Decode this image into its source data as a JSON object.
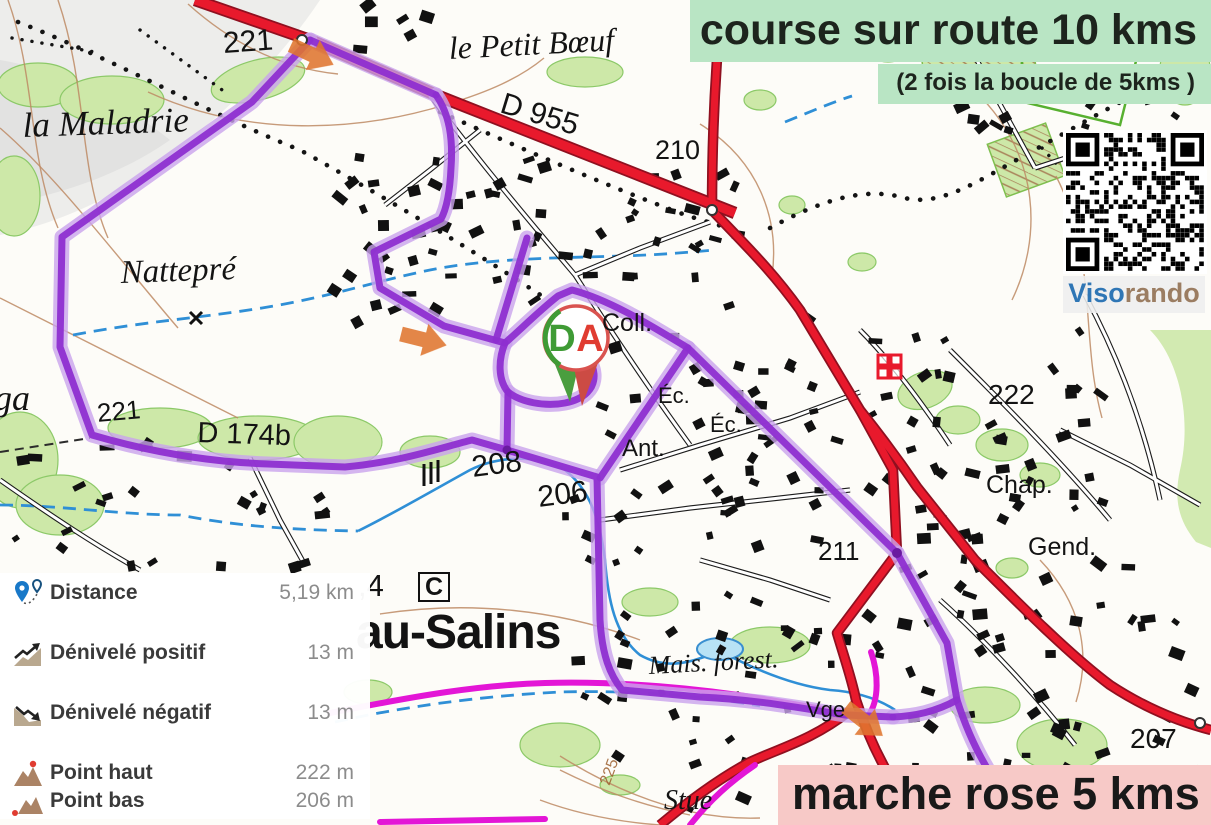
{
  "colors": {
    "route_purple": "#8e2fd0",
    "route_magenta": "#e316d6",
    "road_red": "#e8192c",
    "banner_green": "#b9e5c4",
    "banner_pink": "#f7c9c7",
    "brand_blue_color": "#2f76b5",
    "brand_brown_color": "#9b7d62"
  },
  "banners": {
    "top_text": "course sur route 10 kms",
    "top_subtitle": "(2 fois la boucle de 5kms )",
    "bottom_text": "marche rose 5 kms"
  },
  "brand": {
    "blue_part": "Viso",
    "brown_part": "rando"
  },
  "marker": {
    "depart_label": "D",
    "arrivee_label": "A"
  },
  "stats_panel": {
    "rows": [
      {
        "icon": "distance-icon",
        "label": "Distance",
        "value": "5,19 km"
      },
      {
        "icon": "ascent-icon",
        "label": "Dénivelé positif",
        "value": "13 m"
      },
      {
        "icon": "descent-icon",
        "label": "Dénivelé négatif",
        "value": "13 m"
      },
      {
        "icon": "high-point-icon",
        "label": "Point haut",
        "value": "222 m"
      },
      {
        "icon": "low-point-icon",
        "label": "Point bas",
        "value": "206 m"
      }
    ]
  },
  "map_labels": [
    {
      "text": "221",
      "x": 222,
      "y": 28,
      "cls": "elev",
      "size": 30,
      "rot": -4
    },
    {
      "text": "le Petit Bœuf",
      "x": 448,
      "y": 32,
      "cls": "place",
      "size": 32,
      "rot": -3
    },
    {
      "text": "D 955",
      "x": 506,
      "y": 88,
      "cls": "road",
      "size": 30,
      "rot": 17
    },
    {
      "text": "210",
      "x": 655,
      "y": 136,
      "cls": "elev",
      "size": 27,
      "rot": 0
    },
    {
      "text": "la Maladrie",
      "x": 22,
      "y": 108,
      "cls": "place",
      "size": 35,
      "rot": -2
    },
    {
      "text": "Nattepré",
      "x": 120,
      "y": 256,
      "cls": "place",
      "size": 33,
      "rot": -2
    },
    {
      "text": "ga",
      "x": -6,
      "y": 380,
      "cls": "place",
      "size": 36,
      "rot": 0
    },
    {
      "text": "221",
      "x": 96,
      "y": 400,
      "cls": "elev",
      "size": 26,
      "rot": -5
    },
    {
      "text": "D 174b",
      "x": 198,
      "y": 418,
      "cls": "road",
      "size": 29,
      "rot": 2
    },
    {
      "text": "208",
      "x": 470,
      "y": 452,
      "cls": "elev",
      "size": 30,
      "rot": -7
    },
    {
      "text": "206",
      "x": 536,
      "y": 482,
      "cls": "elev",
      "size": 30,
      "rot": -7
    },
    {
      "text": ",4",
      "x": 358,
      "y": 570,
      "cls": "elev",
      "size": 31,
      "rot": 0
    },
    {
      "text": "C",
      "x": 418,
      "y": 572,
      "cls": "boxed",
      "size": 25,
      "rot": 0
    },
    {
      "text": "au-Salins",
      "x": 356,
      "y": 608,
      "cls": "town",
      "size": 48,
      "rot": 0
    },
    {
      "text": "Coll.",
      "x": 602,
      "y": 310,
      "cls": "amenity",
      "size": 25,
      "rot": 0
    },
    {
      "text": "Éc.",
      "x": 658,
      "y": 384,
      "cls": "amenity",
      "size": 22,
      "rot": 0
    },
    {
      "text": "Éc.",
      "x": 710,
      "y": 413,
      "cls": "amenity",
      "size": 22,
      "rot": 0
    },
    {
      "text": "Ant.",
      "x": 622,
      "y": 436,
      "cls": "amenity",
      "size": 24,
      "rot": 0
    },
    {
      "text": "Mais. forest.",
      "x": 648,
      "y": 652,
      "cls": "place",
      "size": 26,
      "rot": -3
    },
    {
      "text": "Vge",
      "x": 806,
      "y": 698,
      "cls": "amenity",
      "size": 22,
      "rot": 0
    },
    {
      "text": "Stue",
      "x": 664,
      "y": 786,
      "cls": "place",
      "size": 28,
      "rot": 0
    },
    {
      "text": "225",
      "x": 598,
      "y": 782,
      "cls": "contour",
      "size": 16,
      "rot": -70
    },
    {
      "text": "222",
      "x": 988,
      "y": 380,
      "cls": "elev",
      "size": 28,
      "rot": 0
    },
    {
      "text": "Chap.",
      "x": 986,
      "y": 472,
      "cls": "amenity",
      "size": 25,
      "rot": 0
    },
    {
      "text": "Gend.",
      "x": 1028,
      "y": 534,
      "cls": "amenity",
      "size": 25,
      "rot": 0
    },
    {
      "text": "211",
      "x": 818,
      "y": 538,
      "cls": "elev",
      "size": 26,
      "rot": 0
    },
    {
      "text": "207",
      "x": 1130,
      "y": 724,
      "cls": "elev",
      "size": 28,
      "rot": 0
    }
  ]
}
